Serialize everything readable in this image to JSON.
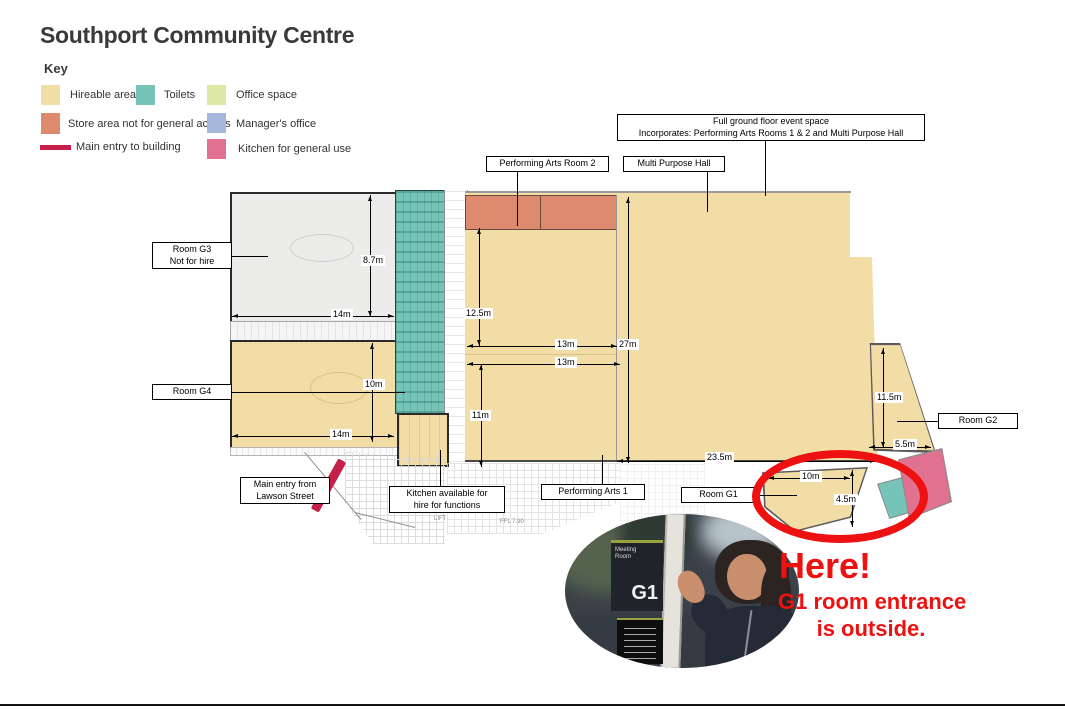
{
  "title": "Southport Community Centre",
  "key": {
    "heading": "Key",
    "items": [
      {
        "id": "hireable",
        "label": "Hireable area",
        "color": "#f3dda6",
        "shape": "swatch"
      },
      {
        "id": "toilets",
        "label": "Toilets",
        "color": "#76c4b8",
        "shape": "swatch"
      },
      {
        "id": "office",
        "label": "Office space",
        "color": "#dde8a4",
        "shape": "swatch"
      },
      {
        "id": "store",
        "label": "Store area not for general access",
        "color": "#dd8a6e",
        "shape": "swatch"
      },
      {
        "id": "manager",
        "label": "Manager's office",
        "color": "#a5b8dc",
        "shape": "swatch"
      },
      {
        "id": "entry",
        "label": "Main entry to building",
        "color": "#c51f4a",
        "shape": "bar"
      },
      {
        "id": "kitchen",
        "label": "Kitchen for general use",
        "color": "#e0718f",
        "shape": "swatch"
      }
    ]
  },
  "plan": {
    "boxed_labels": {
      "full_event_space": "Full ground floor event space\nIncorporates: Performing Arts Rooms 1 & 2 and Multi Purpose Hall",
      "performing_arts_room_2": "Performing Arts Room 2",
      "multi_purpose_hall": "Multi Purpose Hall",
      "room_g3": "Room G3\nNot  for hire",
      "room_g4": "Room G4",
      "main_entry": "Main entry from\nLawson Street",
      "kitchen": "Kitchen available for\nhire for functions",
      "performing_arts_1": "Performing Arts 1",
      "room_g1": "Room G1",
      "room_g2": "Room G2"
    },
    "dimensions": {
      "g3_height": "8.7m",
      "g3_width": "14m",
      "g4_height": "10m",
      "g4_width": "14m",
      "pa2_height": "12.5m",
      "pa2_width_top": "13m",
      "pa2_width_bottom": "13m",
      "pa1_height": "11m",
      "hall_height": "27m",
      "hall_width": "23.5m",
      "g2_height": "11.5m",
      "g2_width": "5.5m",
      "g1_width": "10m",
      "g1_height": "4.5m"
    },
    "background_texts": {
      "lift": "LIFT",
      "ffl": "FFL 7.90"
    }
  },
  "annotation": {
    "headline": "Here!",
    "line1": "G1 room entrance",
    "line2": "is outside.",
    "color": "#ee1111"
  },
  "photo": {
    "sign_header": "Meeting\nRoom",
    "sign_room": "G1"
  },
  "colors": {
    "hireable": "#f3dda6",
    "toilets": "#76c4b8",
    "office": "#dde8a4",
    "store": "#dd8a6e",
    "manager": "#a5b8dc",
    "entry": "#c51f4a",
    "kitchen": "#e0718f",
    "room_g3_fill": "#ececeb",
    "annotation_red": "#ee1111"
  }
}
